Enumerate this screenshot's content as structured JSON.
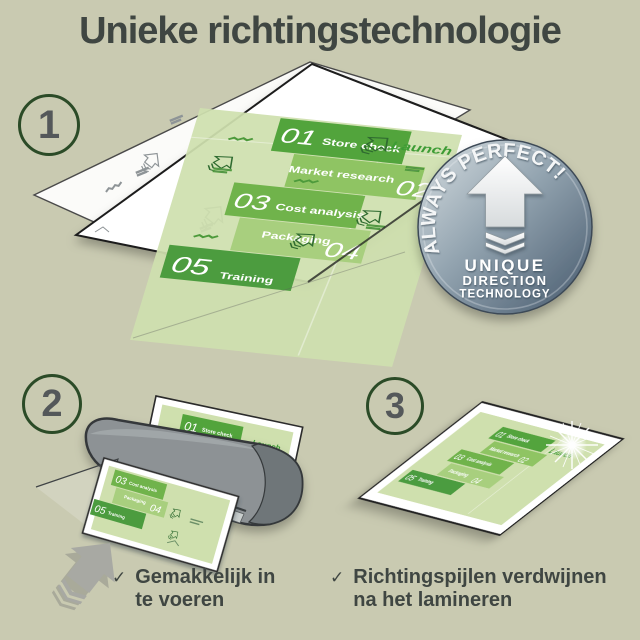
{
  "title": "Unieke richtingstechnologie",
  "steps": [
    "1",
    "2",
    "3"
  ],
  "badge": {
    "arc_text": "ALWAYS PERFECT!",
    "line1": "UNIQUE",
    "line2": "DIRECTION",
    "line3": "TECHNOLOGY"
  },
  "infographic": {
    "launch": "Launch",
    "items": [
      {
        "num": "01",
        "label": "Store check"
      },
      {
        "num": "02",
        "label": "Market research"
      },
      {
        "num": "03",
        "label": "Cost analysis"
      },
      {
        "num": "04",
        "label": "Packaging"
      },
      {
        "num": "05",
        "label": "Training"
      }
    ]
  },
  "checklist": {
    "check_glyph": "✓",
    "items": [
      {
        "line1": "Gemakkelijk in",
        "line2": "te voeren"
      },
      {
        "line1": "Richtingspijlen verdwijnen",
        "line2": "na het lamineren"
      }
    ]
  },
  "colors": {
    "background": "#c9cab1",
    "text": "#3f4642",
    "circle_ring": "#2b4b27",
    "doc_base": "#cfe0ae",
    "band_01": "#52a43c",
    "band_02": "#8fc463",
    "band_03": "#70b34b",
    "band_04": "#a8cf7e",
    "band_05": "#4c9c3f",
    "launch_green": "#3d9c35",
    "badge_light": "#d6dde0",
    "badge_dark": "#47586b",
    "laminator_gray": "#8d9295",
    "arrow_gray": "#a8a9a3"
  }
}
